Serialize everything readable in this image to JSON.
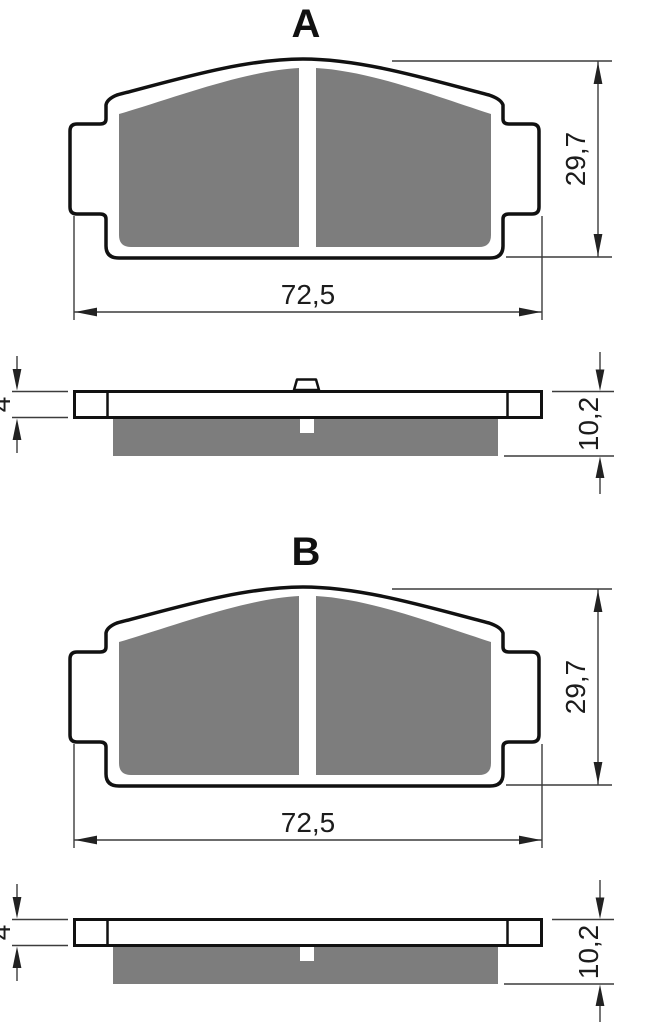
{
  "drawing": {
    "type": "brake-pad technical drawing, two variants with front view and side section view",
    "background_color": "#ffffff",
    "outline_color": "#111111",
    "friction_material_color": "#7d7d7d",
    "dimension_line_color": "#3c3c3c",
    "text_color": "#1c1c1c"
  },
  "sections": [
    {
      "letter": "A",
      "dimensions": {
        "pad_width": "72,5",
        "pad_height": "29,7",
        "plate_thickness": "4",
        "total_thickness": "10,2"
      },
      "side_view_has_center_tab": true
    },
    {
      "letter": "B",
      "dimensions": {
        "pad_width": "72,5",
        "pad_height": "29,7",
        "plate_thickness": "4",
        "total_thickness": "10,2"
      },
      "side_view_has_center_tab": false
    }
  ]
}
